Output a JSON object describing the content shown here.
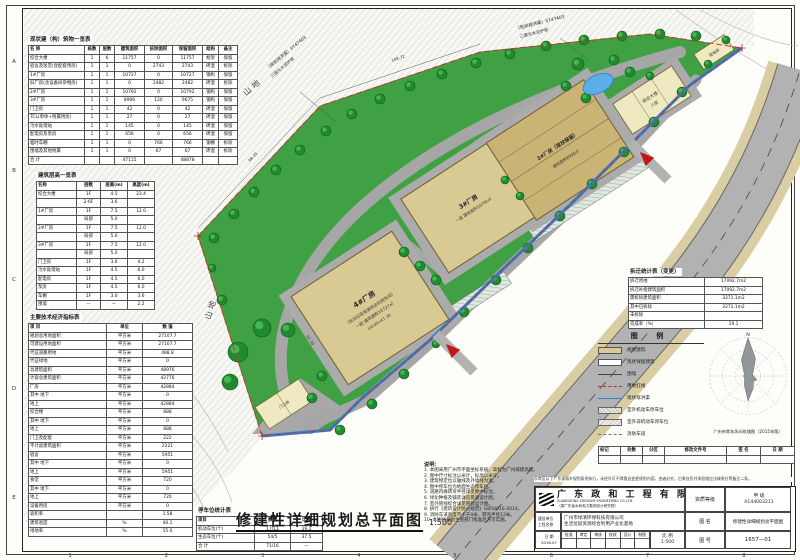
{
  "frame": {
    "grid_numbers": [
      "1",
      "2",
      "3",
      "4",
      "5",
      "6",
      "7",
      "8"
    ],
    "grid_letters": [
      "A",
      "B",
      "C",
      "D",
      "E"
    ]
  },
  "main_title": {
    "text": "修建性详细规划总平面图",
    "scale": "1:500"
  },
  "plan": {
    "terrain_label_1": "山地",
    "terrain_label_2": "山地",
    "channel_note_1": "（现状排洪渠）0747403",
    "channel_note_2": "三面光水泥护坡",
    "road_label_1": "现状水泥路",
    "road_label_2": "（规划红线外）",
    "dim_1": "98.35",
    "dim_2": "168.72",
    "dim_3": "42.10",
    "b1": [
      "4#厂房",
      "（生活垃圾资源综合利用车间）",
      "一层 建筑面积10727㎡",
      "±0.00=47.30"
    ],
    "b2": [
      "3#厂房",
      "一层 建筑面积10792㎡"
    ],
    "b3": [
      "2#厂房（现状保留）",
      "建筑面积8906㎡"
    ],
    "b4": [
      "综合大楼",
      "六层"
    ],
    "b5": "配电房",
    "gate": "门卫房"
  },
  "building_table": {
    "title": "现状建（构）筑物一览表",
    "head": [
      [
        "名  称",
        "栋数",
        "层数",
        "建筑面积",
        "拆除面积",
        "保留面积",
        "结构",
        "备注"
      ]
    ],
    "rows": [
      [
        "综合大楼",
        "1",
        "6",
        "11757",
        "0",
        "11757",
        "框架",
        "保留"
      ],
      [
        "宿舍及饭堂(含配套用房)",
        "1",
        "1",
        "0",
        "2743",
        "2743",
        "砖混",
        "拆除"
      ],
      [
        "1#厂房",
        "1",
        "1",
        "10727",
        "0",
        "10727",
        "钢构",
        "保留"
      ],
      [
        "旧厂房(含设备间杂物房)",
        "1",
        "1",
        "0",
        "2482",
        "2482",
        "砖混",
        "拆除"
      ],
      [
        "2#厂房",
        "1",
        "1",
        "10792",
        "0",
        "10792",
        "钢构",
        "保留"
      ],
      [
        "3#厂房",
        "1",
        "1",
        "8906",
        "120",
        "9675",
        "钢构",
        "保留"
      ],
      [
        "门卫房",
        "1",
        "1",
        "42",
        "0",
        "42",
        "砖混",
        "保留"
      ],
      [
        "TCL(单体+附属用房)",
        "1",
        "1",
        "27",
        "0",
        "27",
        "砖混",
        "保留"
      ],
      [
        "污水处理站",
        "1",
        "1",
        "145",
        "0",
        "145",
        "砖混",
        "保留"
      ],
      [
        "配电房及泵房",
        "1",
        "1",
        "656",
        "0",
        "656",
        "砖混",
        "保留"
      ],
      [
        "临时车棚",
        "1",
        "1",
        "0",
        "766",
        "766",
        "钢棚",
        "拆除"
      ],
      [
        "围墙及其他附属",
        "1",
        "1",
        "0",
        "67",
        "67",
        "砖混",
        "拆除"
      ],
      [
        "合  计",
        "",
        "",
        "47115",
        "",
        "48878",
        "",
        ""
      ]
    ]
  },
  "floor_table": {
    "title": "建筑层高一览表",
    "head": [
      [
        "名称",
        "层数",
        "层高(m)",
        "高度(m)"
      ]
    ],
    "rows": [
      [
        "综合大楼",
        "1F",
        "4.5",
        "23.4"
      ],
      [
        "",
        "2-6F",
        "3.6",
        ""
      ],
      [
        "1#厂房",
        "1F",
        "7.5",
        "12.0"
      ],
      [
        "",
        "局部",
        "5.0",
        ""
      ],
      [
        "2#厂房",
        "1F",
        "7.5",
        "12.0"
      ],
      [
        "",
        "局部",
        "5.0",
        ""
      ],
      [
        "3#厂房",
        "1F",
        "7.5",
        "12.0"
      ],
      [
        "",
        "局部",
        "5.0",
        ""
      ],
      [
        "门卫房",
        "1F",
        "3.6",
        "4.2"
      ],
      [
        "污水处理站",
        "1F",
        "4.5",
        "6.0"
      ],
      [
        "配电房",
        "1F",
        "4.5",
        "6.0"
      ],
      [
        "泵房",
        "1F",
        "4.5",
        "6.0"
      ],
      [
        "车棚",
        "1F",
        "3.0",
        "3.6"
      ],
      [
        "围墙",
        "—",
        "—",
        "2.2"
      ]
    ]
  },
  "econ_table": {
    "title": "主要技术经济指标表",
    "head": [
      [
        "项  目",
        "单位",
        "数 值"
      ]
    ],
    "rows": [
      [
        "规划总用地面积",
        "平方米",
        "27107.7"
      ],
      [
        "可建设用地面积",
        "平方米",
        "27107.7"
      ],
      [
        "代征道路用地",
        "平方米",
        "488.8"
      ],
      [
        "代征绿地",
        "平方米",
        "0"
      ],
      [
        "总建筑面积",
        "平方米",
        "48976"
      ],
      [
        "计容总建筑面积",
        "平方米",
        "42776"
      ],
      [
        "厂房",
        "平方米",
        "42884"
      ],
      [
        "其中 地下",
        "平方米",
        "0"
      ],
      [
        "地上",
        "平方米",
        "42884"
      ],
      [
        "综合楼",
        "平方米",
        "888"
      ],
      [
        "其中 地下",
        "平方米",
        "0"
      ],
      [
        "地上",
        "平方米",
        "888"
      ],
      [
        "门卫及配套",
        "平方米",
        "222"
      ],
      [
        "不计容建筑面积",
        "平方米",
        "2221"
      ],
      [
        "宿舍",
        "平方米",
        "5951"
      ],
      [
        "其中 地下",
        "平方米",
        "0"
      ],
      [
        "地上",
        "平方米",
        "5951"
      ],
      [
        "食堂",
        "平方米",
        "720"
      ],
      [
        "其中 地下",
        "平方米",
        "0"
      ],
      [
        "地上",
        "平方米",
        "720"
      ],
      [
        "设备用房",
        "平方米",
        "0"
      ],
      [
        "容积率",
        "",
        "1.58"
      ],
      [
        "建筑密度",
        "%",
        "40.1"
      ],
      [
        "绿地率",
        "%",
        "15.0"
      ]
    ]
  },
  "parking_table": {
    "title": "停车位统计表",
    "head": [
      [
        "项目",
        "数量",
        "比例"
      ]
    ],
    "rows": [
      [
        "机动车位(个)",
        "17/11",
        "19.1"
      ],
      [
        "生态车位(个)",
        "54/5",
        "37.5"
      ],
      [
        "合  计",
        "71/16",
        "—"
      ]
    ]
  },
  "demolition_table": {
    "title": "拆迁统计表（变更）",
    "rows": [
      [
        "拆迁用地",
        "17092.7m2"
      ],
      [
        "拆迁补偿建筑面积",
        "17092.7m2"
      ],
      [
        "需拆除建筑面积",
        "3271.1m2"
      ],
      [
        "其中已拆除",
        "3271.1m2"
      ],
      [
        "未拆除",
        ""
      ],
      [
        "完成率（%）",
        "19.1"
      ]
    ]
  },
  "legend": {
    "title": "图 例",
    "items": [
      {
        "label": "规划建筑"
      },
      {
        "label": "现状保留建筑"
      },
      {
        "label": "围墙"
      },
      {
        "label": "用地红线"
      },
      {
        "label": "现状排洪渠"
      },
      {
        "label": "室外机动车停车位"
      },
      {
        "label": "室外非机动车停车位"
      },
      {
        "label": "消防车道"
      }
    ]
  },
  "windrose": {
    "north": "N",
    "caption": "广州市常年风向玫瑰图（2015年版）"
  },
  "revision": {
    "headers": [
      [
        "标记",
        "处数",
        "分区",
        "修改文件号",
        "签 名",
        "日 期"
      ]
    ]
  },
  "notes": {
    "title": "说明：",
    "lines": [
      "1. 本图采用广州市平面坐标系统，高程为广州城建高程。",
      "2. 图中尺寸标注以米计，标高以米计。",
      "3. 建筑物定位以轴线及外墙线为准。",
      "4. 图中停车位为地面生态停车位。",
      "5. 道路内缘转弯半径详见图中标注。",
      "6. 绿化种植及铺装详见景观设计图。",
      "7. 室外管线综合详见管综设计图。",
      "8. 执行《建筑设计防火规范》GB50016-2014。",
      "9. 消防车道宽度不小于4米，转弯半径12米。",
      "10. 本图经规划主管部门批准后方可实施。"
    ]
  },
  "titleblock": {
    "note": "水库区以下广东省城乡规划条例执行，未经许可不得擅自变更规划内容，违者必究，后果自负并承担相应法律责任等备注二条。",
    "company": "广 东 政 和 工 程 有 限 公 司",
    "company_en": "GUANGDONG ZHENGHE ENGINEERING CO.,LTD.",
    "company_sub": "（原广东省水利电力勘测设计研究院）",
    "grade_label": "资质等级",
    "grade": "甲 级",
    "cert_no": "A144003211",
    "owner_label": "建设单位",
    "project_label": "工程名称",
    "owner": "广州市绿清环保科技有限公司",
    "project": "生活垃圾资源综合利用产业化基地",
    "fig_label": "图 名",
    "fig_name": "修建性详细规划总平面图",
    "scale_label": "比 例",
    "scale": "1:500",
    "no_label": "图 号",
    "no": "1657—01",
    "date_label": "日 期",
    "date": "2016.07",
    "sigs": [
      "批准",
      "审定",
      "审核",
      "校核",
      "设计",
      "制图"
    ]
  }
}
